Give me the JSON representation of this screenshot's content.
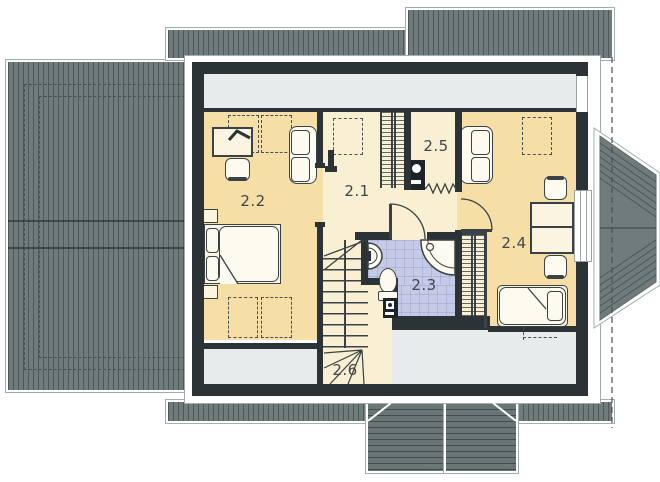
{
  "plan_title": "Attic floor plan",
  "rooms": {
    "r21": {
      "label": "2.1",
      "name": "hall-landing"
    },
    "r22": {
      "label": "2.2",
      "name": "bedroom-left"
    },
    "r23": {
      "label": "2.3",
      "name": "bathroom"
    },
    "r24": {
      "label": "2.4",
      "name": "bedroom-right"
    },
    "r25": {
      "label": "2.5",
      "name": "utility-room"
    },
    "r26": {
      "label": "2.6",
      "name": "staircase"
    }
  },
  "furniture": {
    "bedroom_left": [
      "desk",
      "desk-lamp",
      "chair",
      "sofa",
      "double-bed",
      "nightstands",
      "skylight-outlines"
    ],
    "bedroom_right": [
      "sofa",
      "desk",
      "two-chairs",
      "single-bed",
      "wardrobe",
      "skylight-outline"
    ],
    "hall": [
      "wardrobe",
      "skylight-outline"
    ],
    "utility": [
      "boiler",
      "flexible-connection-zigzag"
    ],
    "bathroom": [
      "washbasin",
      "toilet",
      "corner-shower",
      "washing-machine"
    ],
    "staircase": [
      "winder-stairs"
    ]
  },
  "colors": {
    "roof": "#6f7c7b",
    "dormer_roof": "#697675",
    "wall": "#2b3336",
    "room_warm": "#f6dfa7",
    "room_light": "#f9efd2",
    "bath_tile": "#c5cbe7",
    "low_ceiling_zone": "#e8ebec",
    "outline": "#a3acae"
  }
}
